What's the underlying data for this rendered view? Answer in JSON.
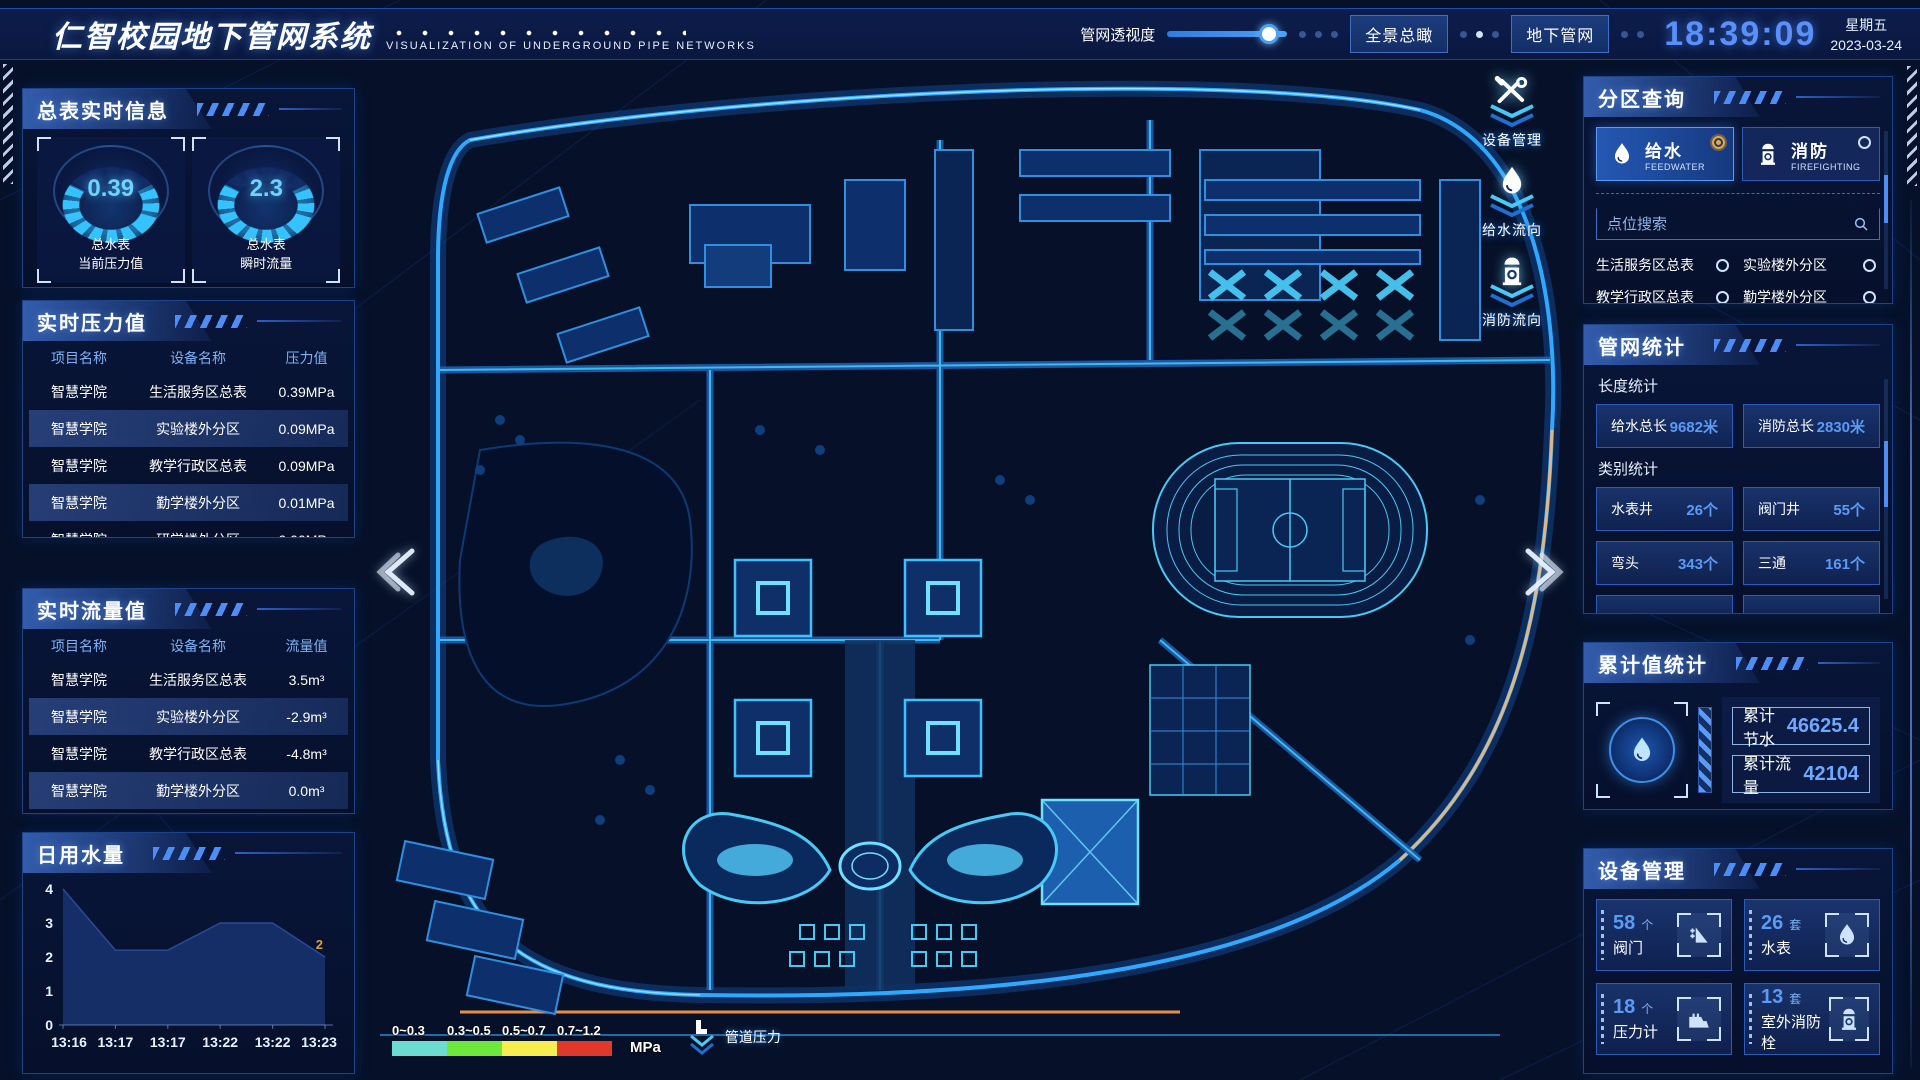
{
  "header": {
    "title": "仁智校园地下管网系统",
    "subtitle": "VISUALIZATION OF UNDERGROUND PIPE NETWORKS",
    "opacity_label": "管网透视度",
    "slider_value": 85,
    "btn_overview": "全景总瞰",
    "btn_underground": "地下管网",
    "time": "18:39:09",
    "weekday": "星期五",
    "date": "2023-03-24"
  },
  "left": {
    "meter_panel": {
      "title": "总表实时信息",
      "gauges": [
        {
          "value": "0.39",
          "label1": "总水表",
          "label2": "当前压力值"
        },
        {
          "value": "2.3",
          "label1": "总水表",
          "label2": "瞬时流量"
        }
      ]
    },
    "pressure_panel": {
      "title": "实时压力值",
      "headers": [
        "项目名称",
        "设备名称",
        "压力值"
      ],
      "rows": [
        [
          "智慧学院",
          "生活服务区总表",
          "0.39MPa"
        ],
        [
          "智慧学院",
          "实验楼外分区",
          "0.09MPa"
        ],
        [
          "智慧学院",
          "教学行政区总表",
          "0.09MPa"
        ],
        [
          "智慧学院",
          "勤学楼外分区",
          "0.01MPa"
        ],
        [
          "智慧学院",
          "研学楼外分区",
          "0.00MPa"
        ]
      ]
    },
    "flow_panel": {
      "title": "实时流量值",
      "headers": [
        "项目名称",
        "设备名称",
        "流量值"
      ],
      "rows": [
        [
          "智慧学院",
          "生活服务区总表",
          "3.5m³"
        ],
        [
          "智慧学院",
          "实验楼外分区",
          "-2.9m³"
        ],
        [
          "智慧学院",
          "教学行政区总表",
          "-4.8m³"
        ],
        [
          "智慧学院",
          "勤学楼外分区",
          "0.0m³"
        ],
        [
          "智慧学院",
          "研学楼外分区",
          "2.2m³"
        ]
      ]
    },
    "daily_panel": {
      "title": "日用水量"
    }
  },
  "chart_data": {
    "type": "area",
    "title": "日用水量",
    "x": [
      "13:16",
      "13:17",
      "13:17",
      "13:22",
      "13:22",
      "13:23"
    ],
    "values": [
      4,
      2.2,
      2.2,
      3,
      3,
      2
    ],
    "ylim": [
      0,
      4
    ],
    "yticks": [
      0,
      1,
      2,
      3,
      4
    ],
    "end_label": "2",
    "fill_color": "#18316b",
    "end_label_color": "#d9a03c"
  },
  "right": {
    "zone_panel": {
      "title": "分区查询",
      "buttons": [
        {
          "label": "给水",
          "sub": "FEEDWATER",
          "icon": "water-drop-icon",
          "selected": true
        },
        {
          "label": "消防",
          "sub": "FIREFIGHTING",
          "icon": "hydrant-icon",
          "selected": false
        }
      ],
      "search_placeholder": "点位搜索",
      "items": [
        "生活服务区总表",
        "实验楼外分区",
        "教学行政区总表",
        "勤学楼外分区",
        "研学楼外分区",
        "宿舍区泵房"
      ]
    },
    "network_panel": {
      "title": "管网统计",
      "length_title": "长度统计",
      "length_stats": [
        {
          "label": "给水总长",
          "value": "9682米"
        },
        {
          "label": "消防总长",
          "value": "2830米"
        }
      ],
      "category_title": "类别统计",
      "category_stats": [
        {
          "label": "水表井",
          "value": "26个"
        },
        {
          "label": "阀门井",
          "value": "55个"
        },
        {
          "label": "弯头",
          "value": "343个"
        },
        {
          "label": "三通",
          "value": "161个"
        }
      ]
    },
    "total_panel": {
      "title": "累计值统计",
      "rows": [
        {
          "label": "累计节水",
          "value": "46625.4"
        },
        {
          "label": "累计流量",
          "value": "42104"
        }
      ]
    },
    "device_panel": {
      "title": "设备管理",
      "cards": [
        {
          "count": "58",
          "unit": "个",
          "name": "阀门",
          "icon": "valve-icon"
        },
        {
          "count": "26",
          "unit": "套",
          "name": "水表",
          "icon": "water-meter-icon"
        },
        {
          "count": "18",
          "unit": "个",
          "name": "压力计",
          "icon": "pressure-gauge-icon"
        },
        {
          "count": "13",
          "unit": "套",
          "name": "室外消防栓",
          "icon": "hydrant-icon"
        }
      ]
    }
  },
  "map": {
    "float_tools": [
      {
        "label": "设备管理",
        "icon": "wrench-icon"
      },
      {
        "label": "给水流向",
        "icon": "water-drop-icon"
      },
      {
        "label": "消防流向",
        "icon": "hydrant-icon"
      }
    ],
    "legend": {
      "ranges": [
        {
          "label": "0~0.3",
          "color": "#6cdcd0"
        },
        {
          "label": "0.3~0.5",
          "color": "#6fe83c"
        },
        {
          "label": "0.5~0.7",
          "color": "#f5ee4e"
        },
        {
          "label": "0.7~1.2",
          "color": "#e0392b"
        }
      ],
      "unit": "MPa",
      "pressure_label": "管道压力"
    }
  },
  "colors": {
    "accent": "#35c2ff",
    "panel_border": "#1d4488",
    "value_blue": "#5b9bf5",
    "time_blue": "#5b8ff9",
    "selected_orange": "#f5a623"
  }
}
